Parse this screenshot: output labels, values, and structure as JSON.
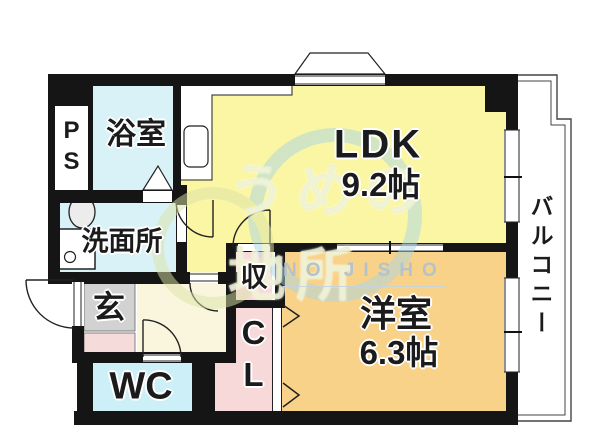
{
  "rooms": {
    "ps": {
      "label": "PS"
    },
    "bathroom": {
      "label": "浴室"
    },
    "ldk": {
      "label": "LDK",
      "size": "9.2帖"
    },
    "washroom": {
      "label": "洗面所"
    },
    "entrance": {
      "label": "玄"
    },
    "wc": {
      "label": "WC"
    },
    "storage": {
      "label": "収"
    },
    "closet": {
      "label": "CL"
    },
    "western_room": {
      "label": "洋室",
      "size": "6.3帖"
    },
    "balcony": {
      "label": "バルコニー"
    }
  },
  "watermark": {
    "text": "うめの地所",
    "subtext": "NO JISHO"
  },
  "colors": {
    "ldk_fill": "#faf6a4",
    "western_room_fill": "#f8d289",
    "bathroom_fill": "#d9f2f8",
    "washroom_fill": "#d9f2f8",
    "wc_fill": "#cdeff7",
    "hallway_fill": "#faf6dd",
    "storage_fill": "#f8d9d9",
    "closet_fill": "#f8d9d9",
    "entrance_fill": "#d2d2d2",
    "porch_fill": "#f6dbdb",
    "wall": "#151515",
    "fixture_fill": "#ffffff",
    "watermark_blue": "#aad6e6",
    "watermark_green": "#dbe4a6"
  }
}
